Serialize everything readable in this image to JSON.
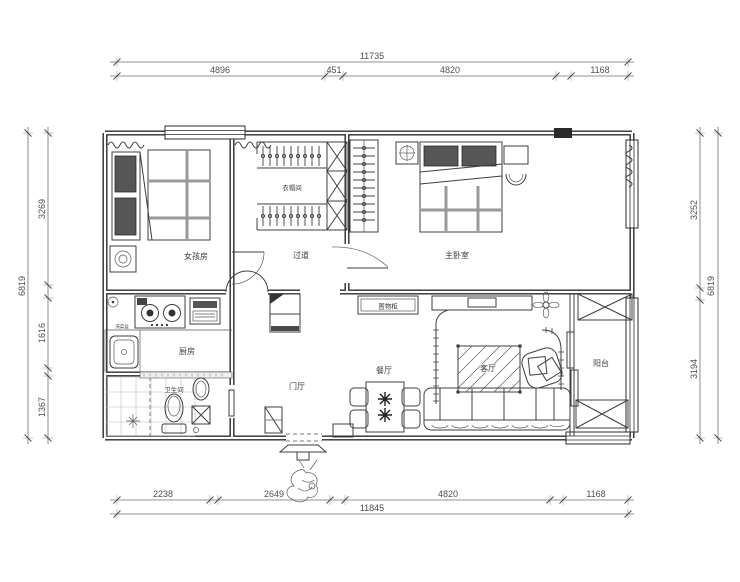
{
  "dims": {
    "top": {
      "overall": "11735",
      "s1": "4896",
      "s2": "451",
      "s3": "4820",
      "s4": "1168"
    },
    "bottom": {
      "overall": "11845",
      "s1": "2238",
      "s2": "2649",
      "s3": "4820",
      "s4": "1168"
    },
    "left": {
      "overall": "6819",
      "s1": "3269",
      "s2": "1616",
      "s3": "1367"
    },
    "right": {
      "overall": "6819",
      "s1": "3252",
      "s2": "3194"
    }
  },
  "rooms": {
    "girls_room": "女孩房",
    "cloakroom": "衣帽间",
    "hallway": "过道",
    "master_bedroom": "主卧室",
    "kitchen": "厨房",
    "bathroom": "卫生间",
    "entry": "门厅",
    "dining": "餐厅",
    "living": "客厅",
    "balcony": "阳台"
  },
  "labels": {
    "storage_cabinet": "置物柜",
    "sink": "洗菜盆"
  },
  "colors": {
    "wall": "#2b2b2b",
    "furniture_line": "#3f3f3f",
    "dimension_line": "#6f6f6f",
    "background": "#ffffff"
  }
}
